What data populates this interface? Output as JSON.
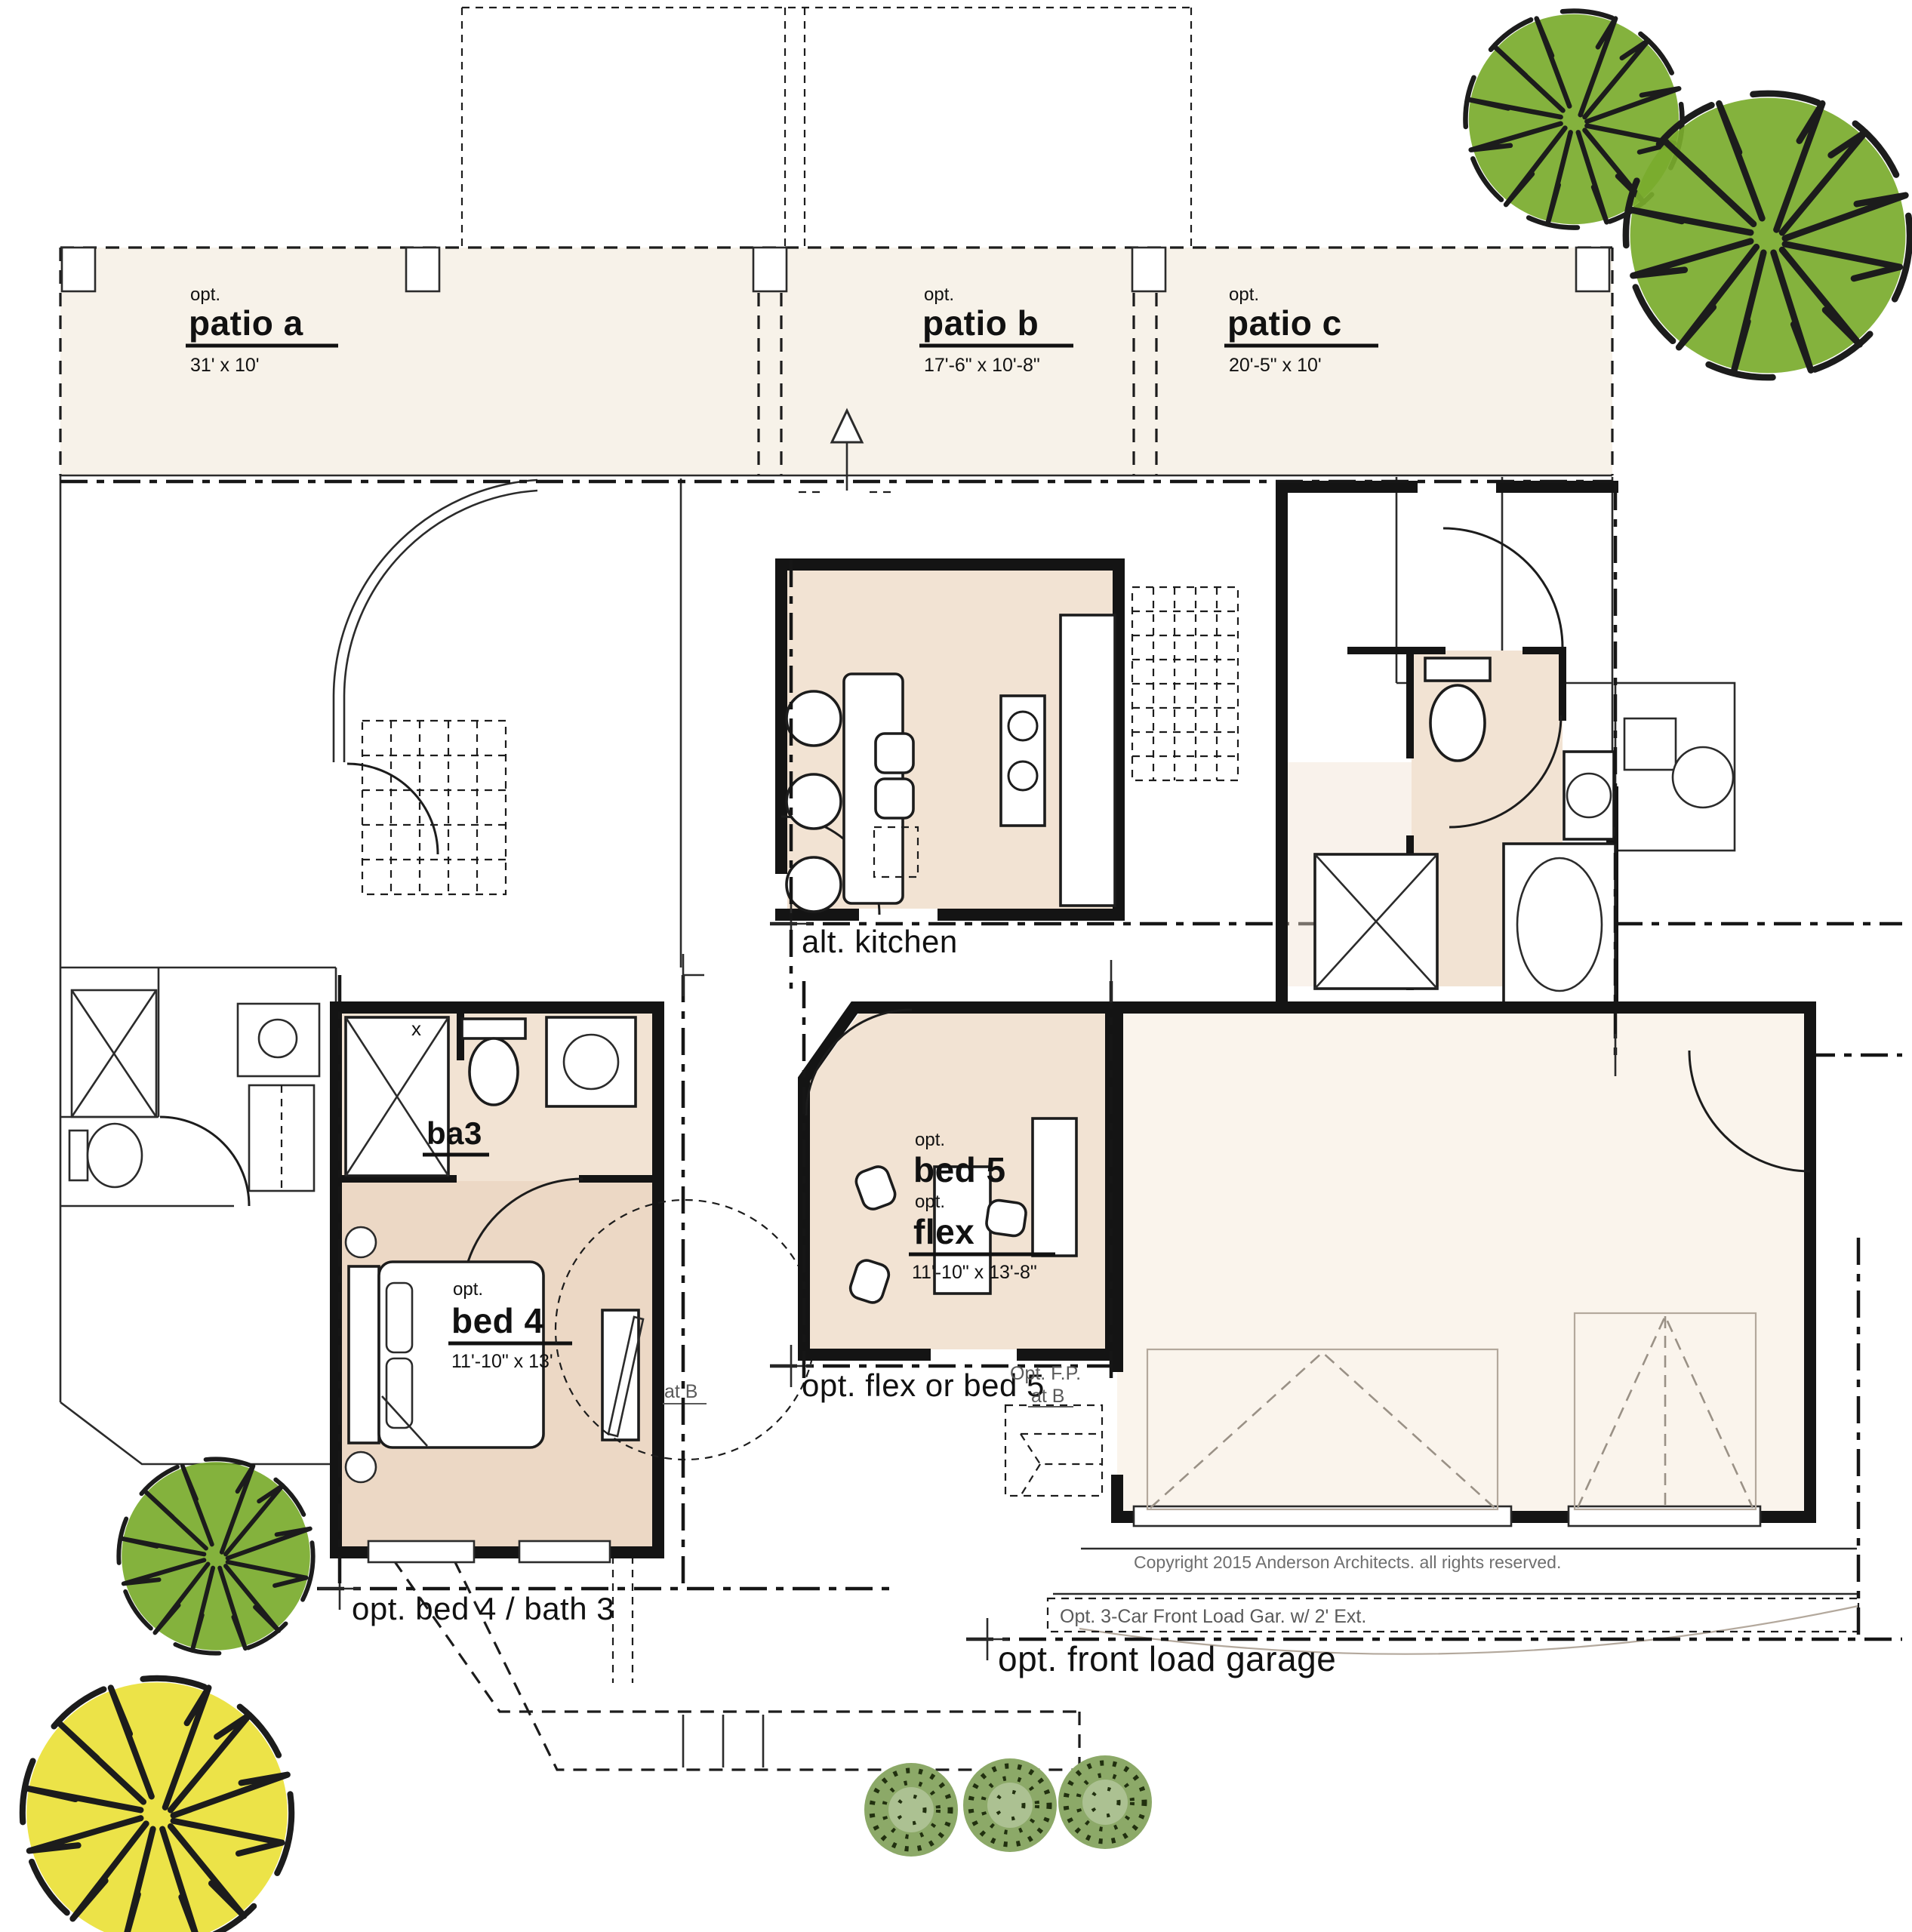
{
  "plan": {
    "patios": [
      {
        "opt": "opt.",
        "name": "patio a",
        "dims": "31' x 10'"
      },
      {
        "opt": "opt.",
        "name": "patio b",
        "dims": "17'-6\" x 10'-8\""
      },
      {
        "opt": "opt.",
        "name": "patio c",
        "dims": "20'-5\" x 10'"
      }
    ],
    "rooms": {
      "kitchen_label": "alt. kitchen",
      "owners_bath_label": "alt. owner's bath",
      "ba3_label": "ba3",
      "bed4": {
        "opt": "opt.",
        "name": "bed 4",
        "dims": "11'-10\" x 13'"
      },
      "bed5": {
        "opt1": "opt.",
        "name1": "bed 5",
        "opt2": "opt.",
        "name2": "flex",
        "dims": "11'-10\" x 13'-8\""
      },
      "flex_gridline_label": "opt. flex or bed 5",
      "bed4_gridline_label": "opt. bed 4 / bath 3",
      "garage_gridline_label": "opt. front load garage"
    },
    "annotations": {
      "fireplace": "Opt. F.P.",
      "at_b_bed4": "at B",
      "at_b_fp": "at B",
      "garage_note": "Opt. 3-Car Front Load Gar. w/ 2' Ext.",
      "copyright": "Copyright 2015 Anderson Architects. all rights reserved.",
      "wall_marker": "x"
    },
    "colors": {
      "patio_fill": "#f7f2e9",
      "room_tan": "#f2e3d3",
      "bed4_tan": "#ecd8c5",
      "garage_fill": "#faf4ec",
      "tree_green": "#79ab2d",
      "tree_yellow": "#ebe23e",
      "bush_green": "#8ca968",
      "wall_black": "#141414"
    }
  }
}
